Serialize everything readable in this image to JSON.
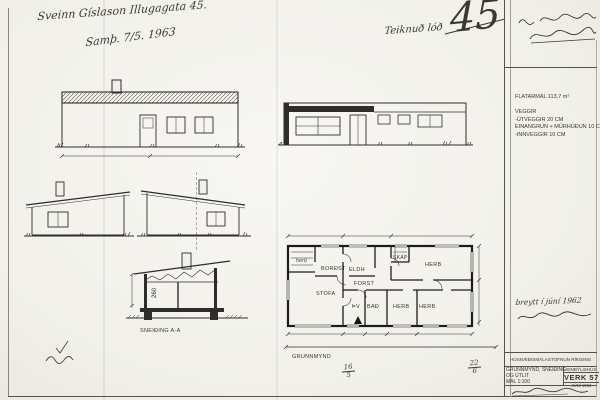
{
  "annotations": {
    "owner_address": "Sveinn Gíslason Illugagata 45.",
    "approval_date": "Samþ. 7/5. 1963",
    "plot_note": "Teiknuð lóð",
    "sheet_number": "45",
    "revision_note": "breytt í júní 1962",
    "date_fraction_left": {
      "top": "16",
      "bottom": "5"
    },
    "date_fraction_right": {
      "top": "22",
      "bottom": "6"
    }
  },
  "specs": {
    "area": "FLATARMÁL 113,7 m²",
    "walls_heading": "VEGGIR",
    "wall_line_1": "-ÚTVEGGIR 20 CM",
    "wall_line_2": "EINANGRUN + MÚRHÚÐUN 10 CM",
    "wall_line_3": "-INNVEGGIR 10 CM"
  },
  "plan": {
    "caption": "GRUNNMYND",
    "rooms": {
      "closet_small": "herb",
      "dining": "BORÐST",
      "kitchen": "ELDH",
      "wardrobe": "SKÁP",
      "bedroom_top": "HERB",
      "hall": "FORST",
      "living": "STOFA",
      "laundry": "ÞV",
      "bath": "BAÐ",
      "bedroom_1": "HERB",
      "bedroom_2": "HERB"
    }
  },
  "section": {
    "caption": "SNEIÐING A-A",
    "ceiling_height": "260"
  },
  "titleblock": {
    "agency": "HÚSNÆÐISMÁLASTOFNUN RÍKISINS",
    "drawing_contents_1": "GRUNNMYND, SNEIÐING",
    "drawing_contents_2": "OG ÚTLIT",
    "scale": "MÁL 1:100",
    "building_type": "EINBÝLISHÚS",
    "work_number": "VERK 57",
    "date": "JÚNÍ 1962"
  },
  "colors": {
    "paper": "#f4f3ee",
    "ink": "#2f2d29"
  }
}
